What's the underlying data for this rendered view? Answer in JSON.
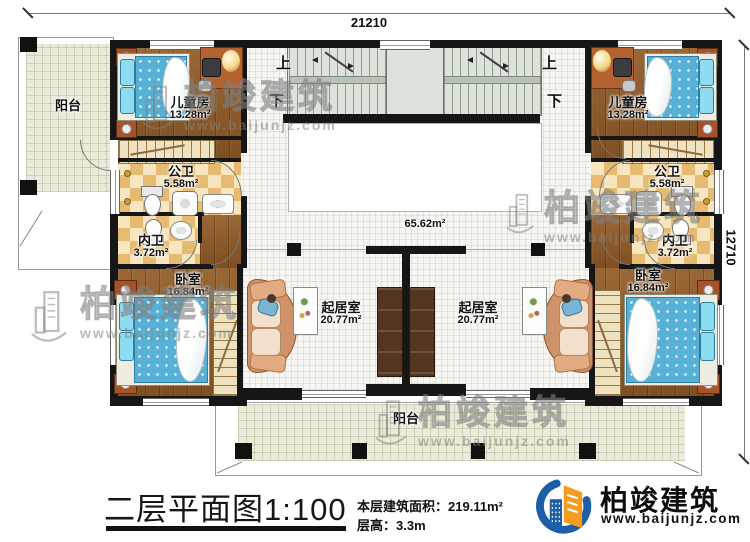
{
  "title_block": {
    "title": "二层平面图1:100",
    "area_label": "本层建筑面积：",
    "area_value": "219.11m²",
    "height_label": "层高：",
    "height_value": "3.3m"
  },
  "dimensions": {
    "width": "21210",
    "height": "12710"
  },
  "hall": {
    "area": "65.62m²"
  },
  "stairs": {
    "up": "上",
    "down": "下"
  },
  "rooms": {
    "balcony_left": {
      "name": "阳台"
    },
    "balcony_bottom": {
      "name": "阳台"
    },
    "child_left": {
      "name": "儿童房",
      "area": "13.28m²"
    },
    "child_right": {
      "name": "儿童房",
      "area": "13.28m²"
    },
    "pub_bath_left": {
      "name": "公卫",
      "area": "5.58m²"
    },
    "pub_bath_right": {
      "name": "公卫",
      "area": "5.58m²"
    },
    "priv_bath_left": {
      "name": "内卫",
      "area": "3.72m²"
    },
    "priv_bath_right": {
      "name": "内卫",
      "area": "3.72m²"
    },
    "bedroom_left": {
      "name": "卧室",
      "area": "16.84m²"
    },
    "bedroom_right": {
      "name": "卧室",
      "area": "16.84m²"
    },
    "living_left": {
      "name": "起居室",
      "area": "20.77m²"
    },
    "living_right": {
      "name": "起居室",
      "area": "20.77m²"
    }
  },
  "logo": {
    "name": "柏竣建筑",
    "url": "www.baijunjz.com"
  },
  "watermark": {
    "text": "柏竣建筑",
    "url": "www.baijunjz.com"
  },
  "colors": {
    "wall": "#161616",
    "wood_floor": "#8f5c2c",
    "bath_tile": "#e7ba72",
    "balcony_tile": "#eceadb",
    "stair": "#dde3da",
    "bed_blue": "#57b1d7",
    "logo_blue": "#1c5fa8",
    "logo_orange": "#f59b1e"
  }
}
